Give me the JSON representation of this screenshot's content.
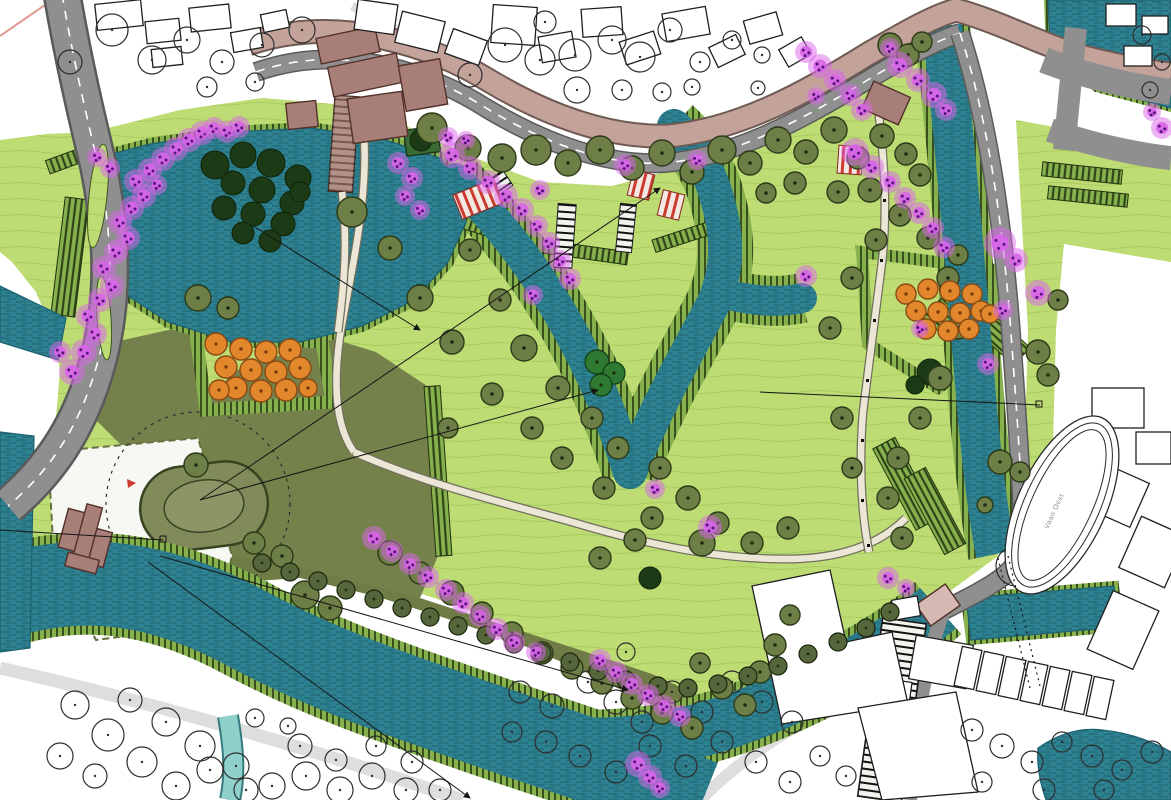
{
  "document": {
    "type": "landscape-masterplan",
    "description": "Illustrative colour site plan of a star-fort park with zig-zag moat, bastions with orchard trees, flowering tree rows, canals, roads and surrounding town context"
  },
  "labels": {
    "track": "Vaan Oost"
  },
  "colors": {
    "water": "#2e8191",
    "water_dark": "#1d6271",
    "water_light": "#8fd0cb",
    "stream_edge": "#35797d",
    "park": "#bddc74",
    "park_line": "#a9cc5f",
    "slope": "#86b14c",
    "slope_tick": "#2f4418",
    "field": "#75814b",
    "field_line": "#65713f",
    "peninsula": "#6f7c45",
    "plaza": "#f7f7f3",
    "tree": "#6e7e47",
    "tree_edge": "#2c3a18",
    "tree_dark": "#1c3a16",
    "green_cluster": "#2f7a33",
    "hedge": "#55663a",
    "blossom": "#d965ea",
    "blossom_dot": "#571577",
    "orange": "#e3872c",
    "orange_edge": "#8a4a14",
    "road": "#8f8f8f",
    "road_edge": "#5a5a5a",
    "road_mauve": "#c3a29a",
    "road_mauve_edge": "#6e5a52",
    "path": "#ece6d6",
    "path_edge": "#70705c",
    "building": "#a87e78",
    "building_edge": "#53302b",
    "context_edge": "#1f1f1f",
    "label": "#8a8a8a",
    "accent_red": "#cc3b2f"
  },
  "map_features": {
    "olive_trees": [
      [
        432,
        128,
        15
      ],
      [
        468,
        148,
        13
      ],
      [
        502,
        158,
        14
      ],
      [
        536,
        150,
        15
      ],
      [
        568,
        163,
        13
      ],
      [
        600,
        150,
        14
      ],
      [
        632,
        168,
        12
      ],
      [
        662,
        153,
        13
      ],
      [
        692,
        172,
        12
      ],
      [
        722,
        150,
        14
      ],
      [
        750,
        163,
        12
      ],
      [
        778,
        140,
        13
      ],
      [
        806,
        152,
        12
      ],
      [
        834,
        130,
        13
      ],
      [
        858,
        158,
        11
      ],
      [
        882,
        136,
        12
      ],
      [
        906,
        154,
        11
      ],
      [
        795,
        183,
        11
      ],
      [
        766,
        193,
        10
      ],
      [
        838,
        192,
        11
      ],
      [
        920,
        175,
        11
      ],
      [
        870,
        190,
        12
      ],
      [
        890,
        45,
        12
      ],
      [
        908,
        55,
        11
      ],
      [
        922,
        42,
        10
      ],
      [
        352,
        212,
        15
      ],
      [
        390,
        248,
        12
      ],
      [
        420,
        298,
        13
      ],
      [
        452,
        342,
        12
      ],
      [
        470,
        250,
        11
      ],
      [
        500,
        300,
        11
      ],
      [
        524,
        348,
        13
      ],
      [
        558,
        388,
        12
      ],
      [
        592,
        418,
        11
      ],
      [
        618,
        448,
        11
      ],
      [
        532,
        428,
        11
      ],
      [
        492,
        394,
        11
      ],
      [
        448,
        428,
        10
      ],
      [
        660,
        468,
        11
      ],
      [
        688,
        498,
        12
      ],
      [
        718,
        523,
        11
      ],
      [
        752,
        543,
        11
      ],
      [
        788,
        528,
        11
      ],
      [
        702,
        543,
        13
      ],
      [
        652,
        518,
        11
      ],
      [
        604,
        488,
        11
      ],
      [
        562,
        458,
        11
      ],
      [
        635,
        540,
        11
      ],
      [
        600,
        558,
        11
      ],
      [
        900,
        215,
        11
      ],
      [
        928,
        238,
        11
      ],
      [
        948,
        278,
        11
      ],
      [
        958,
        328,
        11
      ],
      [
        940,
        378,
        12
      ],
      [
        920,
        418,
        11
      ],
      [
        898,
        458,
        11
      ],
      [
        888,
        498,
        11
      ],
      [
        902,
        538,
        11
      ],
      [
        852,
        468,
        10
      ],
      [
        842,
        418,
        11
      ],
      [
        830,
        328,
        11
      ],
      [
        852,
        278,
        11
      ],
      [
        876,
        240,
        11
      ],
      [
        958,
        255,
        10
      ],
      [
        390,
        553,
        12
      ],
      [
        420,
        573,
        11
      ],
      [
        452,
        593,
        12
      ],
      [
        482,
        613,
        11
      ],
      [
        512,
        633,
        11
      ],
      [
        542,
        653,
        11
      ],
      [
        572,
        668,
        11
      ],
      [
        602,
        683,
        11
      ],
      [
        632,
        698,
        11
      ],
      [
        662,
        713,
        11
      ],
      [
        692,
        728,
        11
      ],
      [
        722,
        688,
        11
      ],
      [
        745,
        705,
        11
      ],
      [
        700,
        663,
        10
      ],
      [
        760,
        672,
        11
      ],
      [
        775,
        645,
        11
      ],
      [
        790,
        615,
        10
      ],
      [
        198,
        298,
        13
      ],
      [
        228,
        308,
        11
      ],
      [
        196,
        465,
        12
      ],
      [
        254,
        543,
        11
      ],
      [
        282,
        556,
        11
      ],
      [
        1000,
        462,
        12
      ],
      [
        1020,
        472,
        10
      ],
      [
        985,
        505,
        8
      ],
      [
        1038,
        352,
        12
      ],
      [
        1048,
        375,
        11
      ],
      [
        1058,
        300,
        10
      ],
      [
        305,
        595,
        14
      ],
      [
        330,
        608,
        12
      ]
    ],
    "hedge_row": [
      [
        262,
        563,
        9
      ],
      [
        290,
        572,
        9
      ],
      [
        318,
        581,
        9
      ],
      [
        346,
        590,
        9
      ],
      [
        374,
        599,
        9
      ],
      [
        402,
        608,
        9
      ],
      [
        430,
        617,
        9
      ],
      [
        458,
        626,
        9
      ],
      [
        486,
        635,
        9
      ],
      [
        514,
        644,
        9
      ],
      [
        542,
        653,
        9
      ],
      [
        570,
        662,
        9
      ],
      [
        598,
        671,
        9
      ],
      [
        626,
        680,
        9
      ],
      [
        658,
        686,
        9
      ],
      [
        688,
        688,
        9
      ],
      [
        718,
        684,
        9
      ],
      [
        748,
        676,
        9
      ],
      [
        778,
        666,
        9
      ],
      [
        808,
        654,
        9
      ],
      [
        838,
        642,
        9
      ],
      [
        866,
        628,
        9
      ],
      [
        890,
        612,
        9
      ]
    ],
    "outline_trees": [
      [
        505,
        45,
        17
      ],
      [
        540,
        60,
        15
      ],
      [
        575,
        55,
        16
      ],
      [
        612,
        40,
        14
      ],
      [
        640,
        57,
        15
      ],
      [
        577,
        90,
        13
      ],
      [
        670,
        30,
        12
      ],
      [
        700,
        62,
        10
      ],
      [
        470,
        75,
        12
      ],
      [
        732,
        40,
        9
      ],
      [
        762,
        55,
        8
      ],
      [
        622,
        90,
        10
      ],
      [
        545,
        22,
        11
      ],
      [
        662,
        92,
        9
      ],
      [
        692,
        87,
        8
      ],
      [
        758,
        88,
        7
      ],
      [
        112,
        30,
        16
      ],
      [
        152,
        60,
        14
      ],
      [
        187,
        40,
        13
      ],
      [
        222,
        62,
        12
      ],
      [
        262,
        45,
        12
      ],
      [
        302,
        30,
        13
      ],
      [
        207,
        87,
        10
      ],
      [
        70,
        62,
        12
      ],
      [
        255,
        82,
        9
      ],
      [
        75,
        705,
        14
      ],
      [
        108,
        735,
        16
      ],
      [
        142,
        762,
        15
      ],
      [
        176,
        786,
        14
      ],
      [
        210,
        770,
        13
      ],
      [
        246,
        790,
        12
      ],
      [
        130,
        700,
        12
      ],
      [
        166,
        722,
        14
      ],
      [
        200,
        746,
        15
      ],
      [
        236,
        766,
        13
      ],
      [
        272,
        786,
        13
      ],
      [
        306,
        776,
        14
      ],
      [
        340,
        790,
        13
      ],
      [
        300,
        746,
        12
      ],
      [
        336,
        760,
        11
      ],
      [
        372,
        776,
        13
      ],
      [
        406,
        790,
        12
      ],
      [
        95,
        776,
        12
      ],
      [
        60,
        756,
        13
      ],
      [
        440,
        790,
        11
      ],
      [
        376,
        746,
        10
      ],
      [
        412,
        762,
        11
      ],
      [
        255,
        718,
        9
      ],
      [
        288,
        726,
        8
      ],
      [
        520,
        692,
        11
      ],
      [
        552,
        706,
        12
      ],
      [
        588,
        682,
        11
      ],
      [
        616,
        702,
        12
      ],
      [
        642,
        722,
        11
      ],
      [
        672,
        692,
        11
      ],
      [
        702,
        712,
        11
      ],
      [
        732,
        682,
        11
      ],
      [
        762,
        702,
        11
      ],
      [
        792,
        722,
        11
      ],
      [
        546,
        742,
        11
      ],
      [
        580,
        756,
        11
      ],
      [
        616,
        772,
        11
      ],
      [
        650,
        746,
        11
      ],
      [
        686,
        766,
        11
      ],
      [
        722,
        742,
        11
      ],
      [
        756,
        762,
        11
      ],
      [
        790,
        782,
        11
      ],
      [
        512,
        732,
        10
      ],
      [
        626,
        652,
        9
      ],
      [
        820,
        756,
        10
      ],
      [
        846,
        776,
        10
      ],
      [
        972,
        730,
        11
      ],
      [
        1002,
        746,
        12
      ],
      [
        1032,
        762,
        11
      ],
      [
        1062,
        742,
        10
      ],
      [
        1092,
        756,
        11
      ],
      [
        1122,
        770,
        10
      ],
      [
        1152,
        752,
        11
      ],
      [
        982,
        782,
        10
      ],
      [
        1044,
        790,
        11
      ],
      [
        1104,
        790,
        10
      ],
      [
        1142,
        35,
        9
      ],
      [
        1162,
        62,
        8
      ],
      [
        1150,
        90,
        8
      ]
    ],
    "dark_blobs": [
      [
        215,
        165,
        14
      ],
      [
        243,
        155,
        13
      ],
      [
        271,
        163,
        14
      ],
      [
        298,
        178,
        13
      ],
      [
        233,
        183,
        12
      ],
      [
        262,
        190,
        13
      ],
      [
        292,
        203,
        12
      ],
      [
        224,
        208,
        12
      ],
      [
        253,
        214,
        12
      ],
      [
        283,
        224,
        12
      ],
      [
        243,
        233,
        11
      ],
      [
        270,
        241,
        11
      ],
      [
        300,
        192,
        10
      ],
      [
        930,
        372,
        13
      ],
      [
        650,
        578,
        11
      ],
      [
        915,
        385,
        9
      ],
      [
        421,
        140,
        11
      ]
    ],
    "green_cluster": [
      [
        597,
        362,
        12
      ],
      [
        614,
        373,
        11
      ],
      [
        601,
        385,
        11
      ]
    ],
    "orange_trees": [
      [
        216,
        344,
        11
      ],
      [
        241,
        349,
        11
      ],
      [
        266,
        352,
        11
      ],
      [
        290,
        350,
        11
      ],
      [
        226,
        367,
        11
      ],
      [
        251,
        370,
        11
      ],
      [
        276,
        372,
        11
      ],
      [
        300,
        368,
        11
      ],
      [
        236,
        388,
        11
      ],
      [
        261,
        391,
        11
      ],
      [
        286,
        390,
        11
      ],
      [
        219,
        390,
        10
      ],
      [
        308,
        388,
        9
      ],
      [
        906,
        294,
        10
      ],
      [
        928,
        289,
        10
      ],
      [
        950,
        291,
        10
      ],
      [
        972,
        294,
        10
      ],
      [
        916,
        311,
        10
      ],
      [
        938,
        312,
        10
      ],
      [
        960,
        313,
        10
      ],
      [
        981,
        311,
        10
      ],
      [
        926,
        329,
        10
      ],
      [
        948,
        331,
        10
      ],
      [
        969,
        329,
        10
      ],
      [
        990,
        314,
        9
      ]
    ],
    "blossom_trees": [
      [
        72,
        372,
        13
      ],
      [
        84,
        352,
        13
      ],
      [
        95,
        334,
        12
      ],
      [
        88,
        316,
        12
      ],
      [
        100,
        300,
        12
      ],
      [
        112,
        286,
        12
      ],
      [
        104,
        268,
        12
      ],
      [
        116,
        252,
        12
      ],
      [
        128,
        238,
        12
      ],
      [
        120,
        222,
        12
      ],
      [
        132,
        208,
        12
      ],
      [
        144,
        196,
        12
      ],
      [
        136,
        181,
        12
      ],
      [
        150,
        170,
        12
      ],
      [
        163,
        159,
        12
      ],
      [
        176,
        149,
        12
      ],
      [
        189,
        140,
        12
      ],
      [
        202,
        133,
        12
      ],
      [
        214,
        128,
        11
      ],
      [
        227,
        132,
        11
      ],
      [
        239,
        127,
        11
      ],
      [
        60,
        352,
        11
      ],
      [
        157,
        185,
        10
      ],
      [
        97,
        157,
        10
      ],
      [
        110,
        168,
        10
      ],
      [
        452,
        155,
        13
      ],
      [
        470,
        168,
        12
      ],
      [
        488,
        182,
        12
      ],
      [
        506,
        196,
        12
      ],
      [
        522,
        210,
        12
      ],
      [
        537,
        226,
        11
      ],
      [
        549,
        243,
        11
      ],
      [
        560,
        261,
        11
      ],
      [
        570,
        279,
        11
      ],
      [
        540,
        190,
        10
      ],
      [
        448,
        137,
        10
      ],
      [
        466,
        140,
        9
      ],
      [
        533,
        295,
        10
      ],
      [
        398,
        163,
        11
      ],
      [
        412,
        178,
        11
      ],
      [
        405,
        196,
        10
      ],
      [
        420,
        210,
        10
      ],
      [
        625,
        165,
        11
      ],
      [
        697,
        160,
        10
      ],
      [
        806,
        52,
        11
      ],
      [
        820,
        66,
        12
      ],
      [
        835,
        80,
        11
      ],
      [
        850,
        95,
        11
      ],
      [
        816,
        96,
        9
      ],
      [
        862,
        110,
        11
      ],
      [
        900,
        65,
        13
      ],
      [
        918,
        80,
        12
      ],
      [
        934,
        95,
        13
      ],
      [
        946,
        110,
        11
      ],
      [
        890,
        48,
        10
      ],
      [
        855,
        152,
        14
      ],
      [
        872,
        167,
        12
      ],
      [
        890,
        182,
        11
      ],
      [
        905,
        198,
        11
      ],
      [
        919,
        213,
        11
      ],
      [
        933,
        228,
        11
      ],
      [
        944,
        247,
        11
      ],
      [
        1000,
        243,
        16
      ],
      [
        1016,
        260,
        12
      ],
      [
        1038,
        293,
        13
      ],
      [
        1003,
        310,
        10
      ],
      [
        988,
        364,
        11
      ],
      [
        920,
        329,
        9
      ],
      [
        1162,
        128,
        11
      ],
      [
        1152,
        112,
        9
      ],
      [
        806,
        276,
        11
      ],
      [
        655,
        489,
        10
      ],
      [
        888,
        578,
        11
      ],
      [
        906,
        588,
        9
      ],
      [
        710,
        527,
        12
      ],
      [
        374,
        538,
        12
      ],
      [
        392,
        551,
        11
      ],
      [
        410,
        564,
        11
      ],
      [
        428,
        577,
        11
      ],
      [
        446,
        590,
        11
      ],
      [
        463,
        603,
        11
      ],
      [
        480,
        616,
        11
      ],
      [
        497,
        629,
        11
      ],
      [
        514,
        642,
        11
      ],
      [
        600,
        660,
        11
      ],
      [
        616,
        672,
        11
      ],
      [
        632,
        684,
        11
      ],
      [
        648,
        695,
        11
      ],
      [
        664,
        706,
        11
      ],
      [
        680,
        716,
        11
      ],
      [
        536,
        652,
        10
      ],
      [
        638,
        764,
        13
      ],
      [
        650,
        777,
        12
      ],
      [
        660,
        788,
        10
      ]
    ]
  }
}
